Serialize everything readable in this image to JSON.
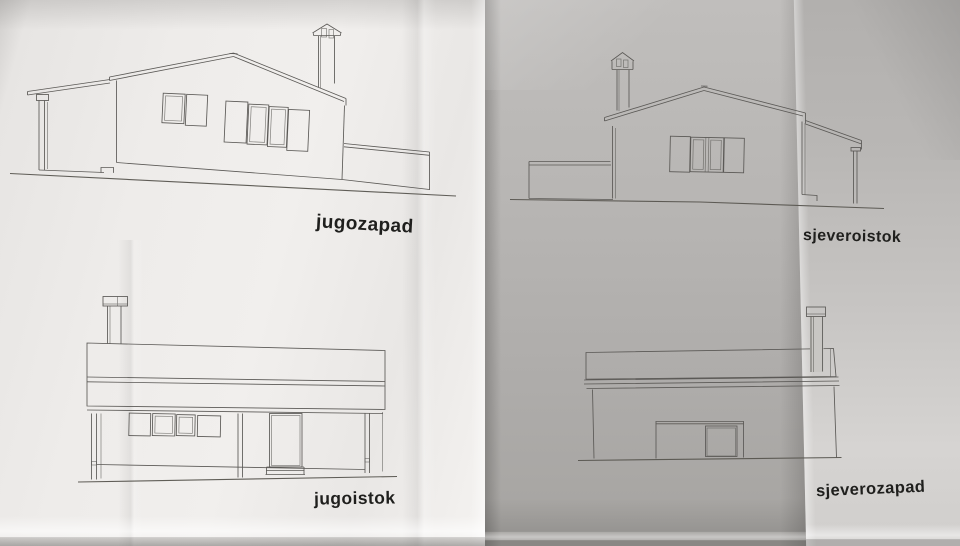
{
  "sheet": {
    "views": [
      {
        "label": "jugozapad",
        "position": "top-left"
      },
      {
        "label": "sjeveroistok",
        "position": "top-right"
      },
      {
        "label": "jugoistok",
        "position": "bottom-left"
      },
      {
        "label": "sjeverozapad",
        "position": "bottom-right"
      }
    ]
  },
  "colors": {
    "paper_left": "#f0eeec",
    "paper_mid": "#b3b1af",
    "paper_right_top": "#b2b0ae",
    "paper_right_bottom": "#d6d4d2",
    "drawing_line": "#5b5956",
    "label_text": "#1f1f1d"
  }
}
